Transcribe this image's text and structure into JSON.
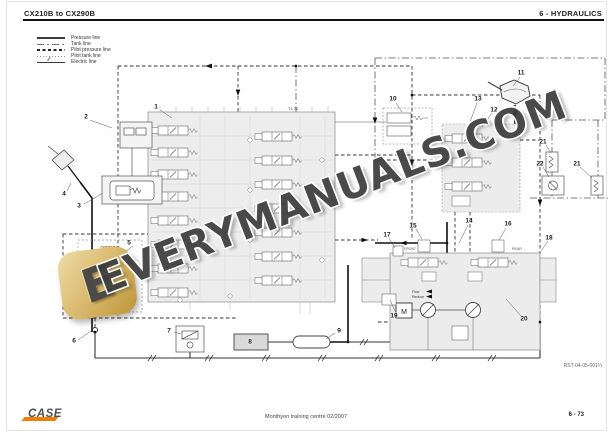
{
  "header": {
    "left": "CX210B to CX290B",
    "right": "6 - HYDRAULICS"
  },
  "legend": {
    "items": [
      {
        "label": "Pressure line",
        "style": "pressure"
      },
      {
        "label": "Tank line",
        "style": "tank"
      },
      {
        "label": "Pilot pressure line",
        "style": "pilot-pressure"
      },
      {
        "label": "Pilot tank line",
        "style": "pilot-tank"
      },
      {
        "label": "Electric line",
        "style": "electric"
      }
    ]
  },
  "diagram": {
    "callouts": [
      {
        "n": "1",
        "x": 156,
        "y": 107
      },
      {
        "n": "2",
        "x": 86,
        "y": 117
      },
      {
        "n": "3",
        "x": 79,
        "y": 206
      },
      {
        "n": "4",
        "x": 64,
        "y": 194
      },
      {
        "n": "5",
        "x": 129,
        "y": 243
      },
      {
        "n": "6",
        "x": 74,
        "y": 341
      },
      {
        "n": "7",
        "x": 169,
        "y": 331
      },
      {
        "n": "8",
        "x": 250,
        "y": 342
      },
      {
        "n": "9",
        "x": 339,
        "y": 331
      },
      {
        "n": "10",
        "x": 393,
        "y": 99
      },
      {
        "n": "11",
        "x": 521,
        "y": 73
      },
      {
        "n": "12",
        "x": 494,
        "y": 110
      },
      {
        "n": "13",
        "x": 478,
        "y": 99
      },
      {
        "n": "14",
        "x": 469,
        "y": 221
      },
      {
        "n": "15",
        "x": 413,
        "y": 226
      },
      {
        "n": "16",
        "x": 508,
        "y": 224
      },
      {
        "n": "17",
        "x": 387,
        "y": 235
      },
      {
        "n": "18",
        "x": 549,
        "y": 238
      },
      {
        "n": "19",
        "x": 394,
        "y": 316
      },
      {
        "n": "20",
        "x": 524,
        "y": 319
      },
      {
        "n": "21",
        "x": 543,
        "y": 142
      },
      {
        "n": "22",
        "x": 540,
        "y": 164
      },
      {
        "n": "21",
        "x": 577,
        "y": 164
      }
    ],
    "labels": {
      "option": "OPTION",
      "breaker": "Breaker",
      "on": "ON",
      "front": "FRONT",
      "rear": "REAR",
      "motor": "M",
      "t1t2": "T1 T2",
      "flow1": "Flow",
      "flow2": "Reduce"
    },
    "ref": "RST-04-05-001¼"
  },
  "watermark": {
    "text": "EVERYMANUALS.COM",
    "logo_letter": "E"
  },
  "footer": {
    "brand": "CASE",
    "center": "Monthyon training centre 02/2007",
    "page": "6 - 73"
  },
  "colors": {
    "accent_orange": "#f07f09",
    "option_orange": "#a86f14",
    "watermark_gray": "#3d3d3d",
    "logo_gold": "#dbbc72",
    "block_gray": "#ececec"
  }
}
